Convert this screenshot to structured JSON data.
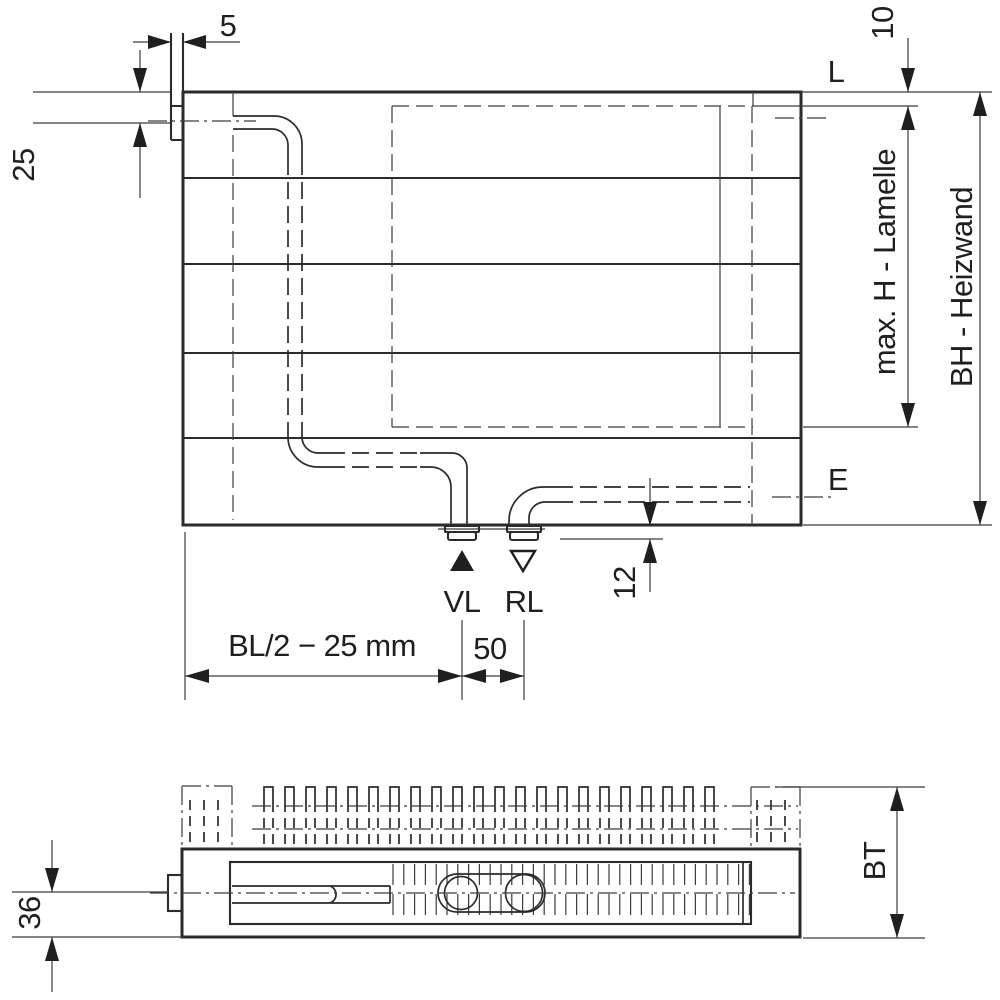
{
  "colors": {
    "line": "#2b2b2b",
    "background": "#ffffff",
    "text": "#1f1f1f"
  },
  "front_view": {
    "dim_bracket_thickness": "5",
    "dim_top_to_center": "25",
    "dim_top_gap": "10",
    "label_left_connection_level": "L",
    "label_lamelle_height": "max. H - Lamelle",
    "label_build_height": "BH - Heizwand",
    "label_side_connection_level": "E",
    "label_supply": "VL",
    "label_return": "RL",
    "dim_stub_projection": "12",
    "dim_supply_position": "BL/2 − 25 mm",
    "dim_connection_spacing": "50"
  },
  "plan_view": {
    "dim_center_to_face": "36",
    "label_build_depth": "BT"
  }
}
